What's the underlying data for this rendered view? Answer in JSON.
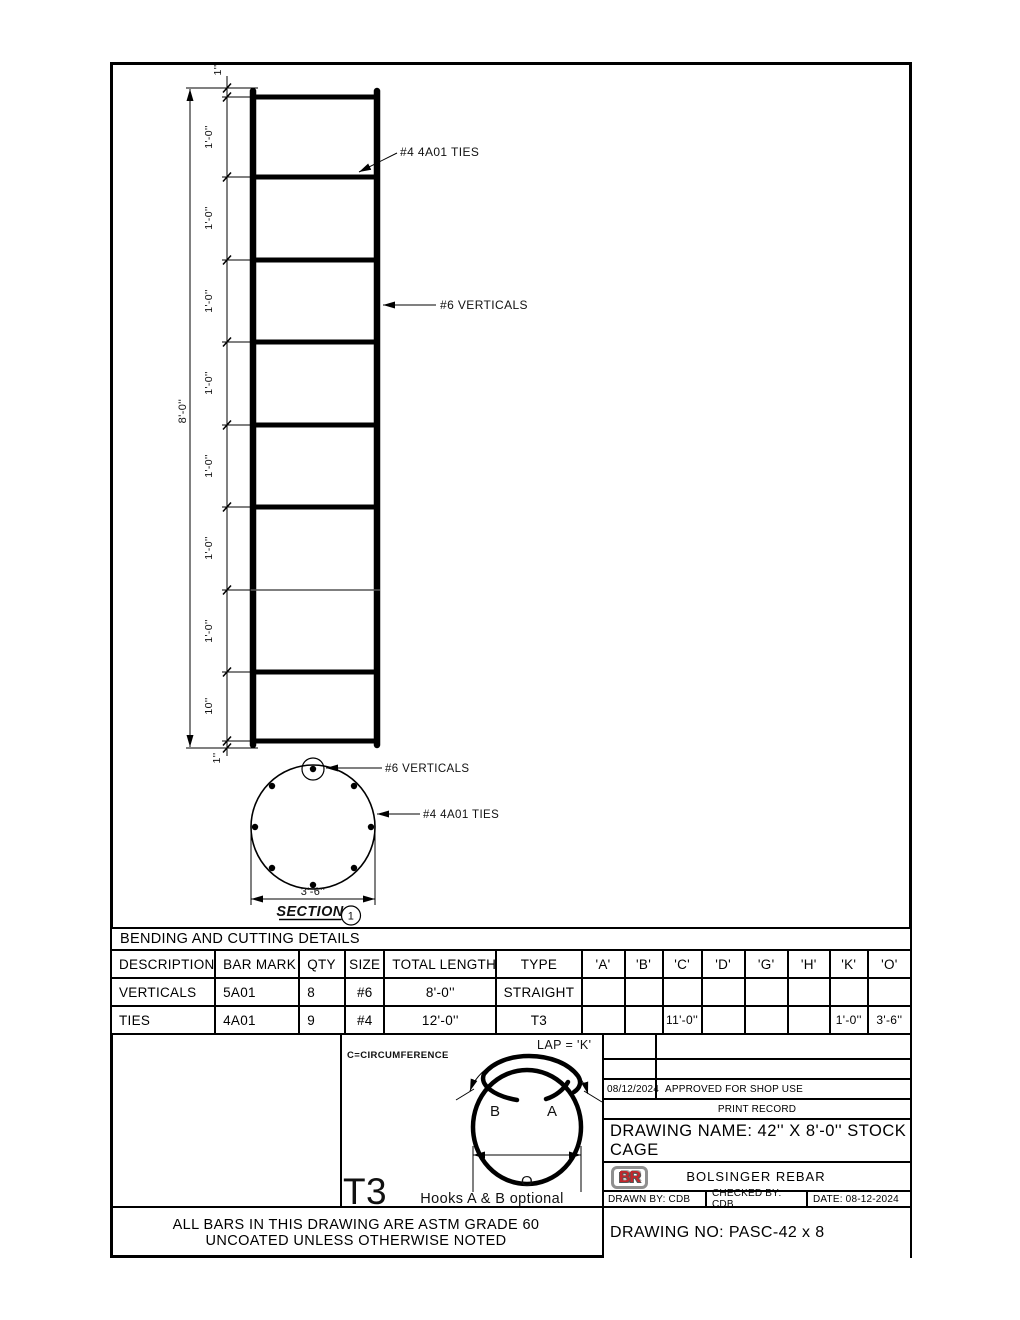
{
  "elevation": {
    "overall": "8'-0''",
    "segments": [
      "1''",
      "1'-0''",
      "1'-0''",
      "1'-0''",
      "1'-0''",
      "1'-0''",
      "1'-0''",
      "1'-0''",
      "10''",
      "1''"
    ],
    "tie_label": "#4 4A01 TIES",
    "vertical_label": "#6 VERTICALS"
  },
  "section": {
    "vertical_label": "#6 VERTICALS",
    "tie_label": "#4 4A01 TIES",
    "diameter": "3'-6''",
    "title": "SECTION",
    "detail_number": "1"
  },
  "bending_table": {
    "title": "BENDING AND CUTTING DETAILS",
    "headers": [
      "DESCRIPTION",
      "BAR MARK",
      "QTY",
      "SIZE",
      "TOTAL LENGTH",
      "TYPE",
      "'A'",
      "'B'",
      "'C'",
      "'D'",
      "'G'",
      "'H'",
      "'K'",
      "'O'"
    ],
    "rows": [
      [
        "VERTICALS",
        "5A01",
        "8",
        "#6",
        "8'-0''",
        "STRAIGHT",
        "",
        "",
        "",
        "",
        "",
        "",
        "",
        ""
      ],
      [
        "TIES",
        "4A01",
        "9",
        "#4",
        "12'-0''",
        "T3",
        "",
        "",
        "11'-0''",
        "",
        "",
        "",
        "1'-0''",
        "3'-6''"
      ]
    ]
  },
  "hook_detail": {
    "circumference_note": "C=CIRCUMFERENCE",
    "lap_label": "LAP = 'K'",
    "hook_b": "B",
    "hook_a": "A",
    "dim_o": "O",
    "type_label": "T3",
    "caption": "Hooks A & B optional"
  },
  "title_block": {
    "print_record_date": "08/12/2024",
    "print_record_desc": "APPROVED FOR SHOP USE",
    "print_record_title": "PRINT RECORD",
    "drawing_name": "DRAWING NAME: 42'' X 8'-0'' STOCK CAGE",
    "logo_text": "BR",
    "company": "BOLSINGER REBAR",
    "drawn_by": "DRAWN BY: CDB",
    "checked_by": "CHECKED BY: CDB",
    "date": "DATE: 08-12-2024",
    "drawing_no": "DRAWING NO: PASC-42 x 8"
  },
  "notes": {
    "line1": "ALL BARS IN THIS DRAWING ARE ASTM GRADE 60",
    "line2": "UNCOATED UNLESS OTHERWISE NOTED"
  },
  "colors": {
    "line": "#000000",
    "thin_tie": "#555555",
    "logo_red": "#c3262b"
  }
}
